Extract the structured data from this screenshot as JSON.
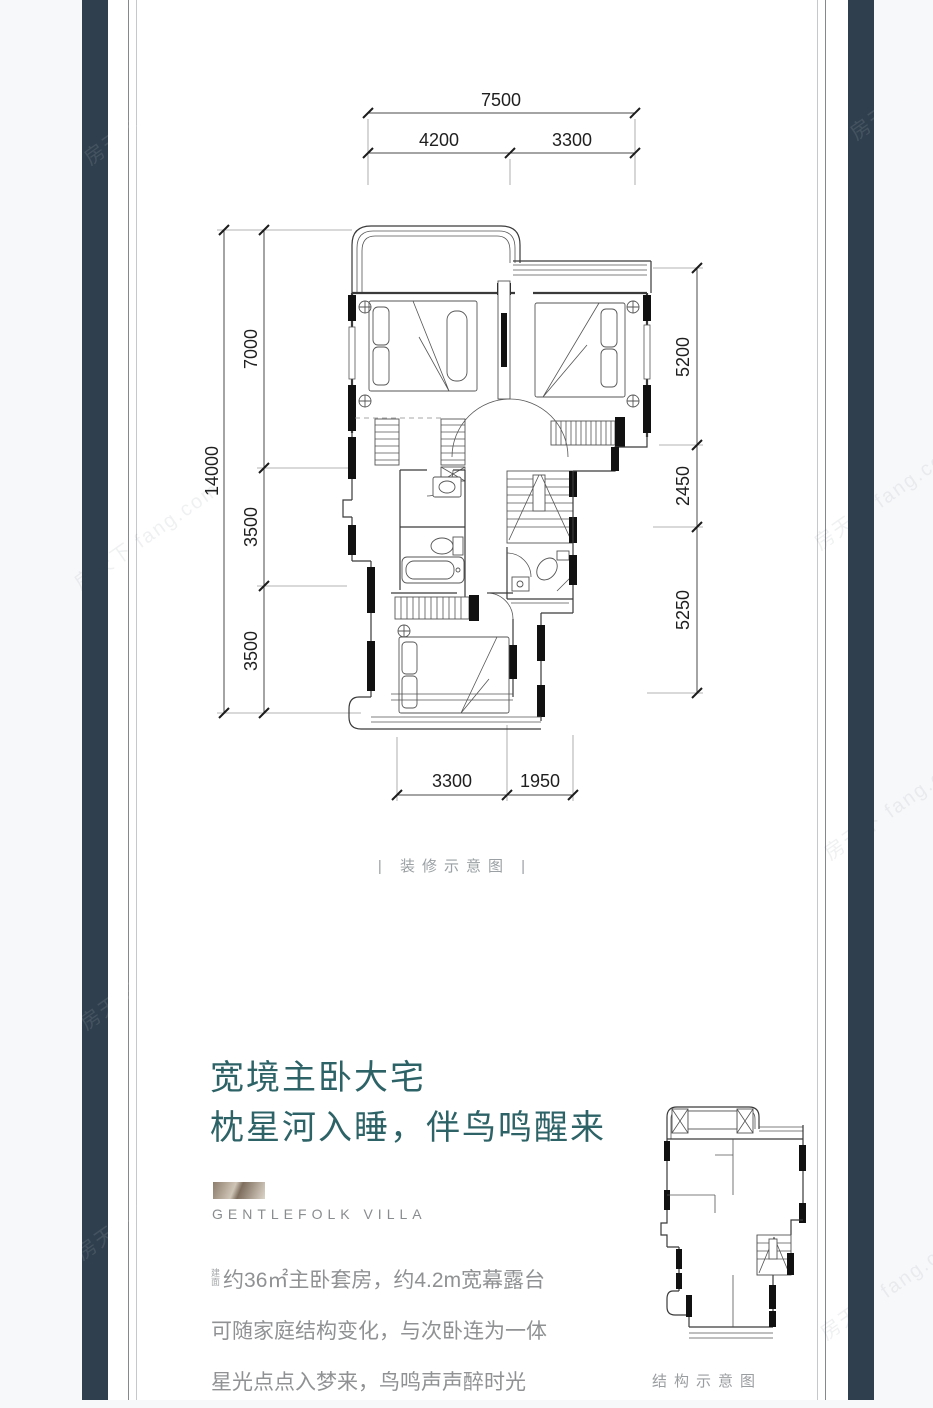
{
  "watermark": "房天下 fang.com",
  "floorplan": {
    "caption": "| 装修示意图 |",
    "dims": {
      "top_total": "7500",
      "top_segments": [
        "4200",
        "3300"
      ],
      "left_total": "14000",
      "left_segments": [
        "7000",
        "3500",
        "3500"
      ],
      "right_segments": [
        "5200",
        "2450",
        "5250"
      ],
      "bottom_segments": [
        "3300",
        "1950"
      ]
    }
  },
  "headline": {
    "line1": "宽境主卧大宅",
    "line2": "枕星河入睡，伴鸟鸣醒来"
  },
  "brand": {
    "name": "GENTLEFOLK VILLA"
  },
  "description": {
    "prefix_top": "建",
    "prefix_bottom": "面",
    "line1": "约36㎡主卧套房，约4.2m宽幕露台",
    "line2": "可随家庭结构变化，与次卧连为一体",
    "line3": "星光点点入梦来，鸟鸣声声醉时光"
  },
  "structure": {
    "caption": "结构示意图"
  },
  "colors": {
    "accent_teal": "#2d6367",
    "panel_dark": "#2f3f4d",
    "logo_bronze": "#a4917d"
  }
}
